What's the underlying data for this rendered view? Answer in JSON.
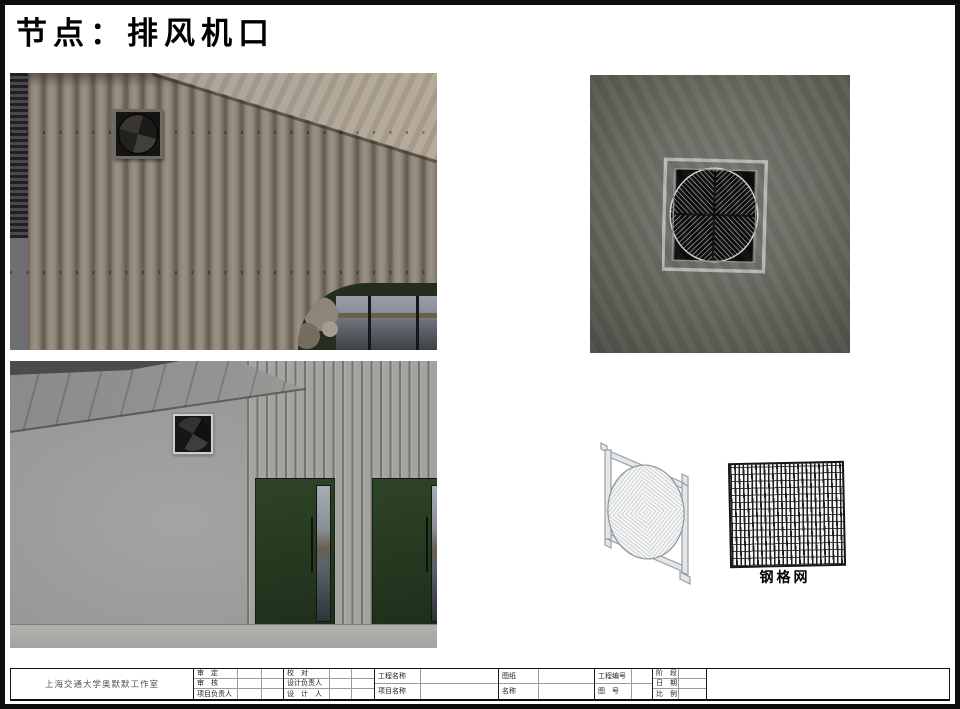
{
  "page": {
    "title": "节点：排风机口"
  },
  "figures": {
    "mesh_label": "钢格网"
  },
  "titleblock": {
    "studio": "上海交通大学奥默默工作室",
    "g1": {
      "r1": "审　定",
      "r2": "审　核",
      "r3": "项目负责人"
    },
    "g2": {
      "r1": "校　对",
      "r2": "设计负责人",
      "r3": "设　计　人"
    },
    "g3": {
      "r1": "工程名称",
      "r2": "项目名称"
    },
    "g4": {
      "r1": "图纸",
      "r2": "名称"
    },
    "g5": {
      "r1": "工程编号",
      "r2": "图　号"
    },
    "g6": {
      "r1": "阶　段",
      "r2": "日　期",
      "r3": "比　例"
    }
  },
  "colors": {
    "ink": "#111111",
    "ribbed_wall": "#8b8377",
    "smooth_wall": "#9d9d9b",
    "closeup_wall": "#6a6e65",
    "door_green": "#2c4026",
    "vent_frame_metal": "#b7b9b8",
    "line_art_gray": "#9aa0a5"
  }
}
